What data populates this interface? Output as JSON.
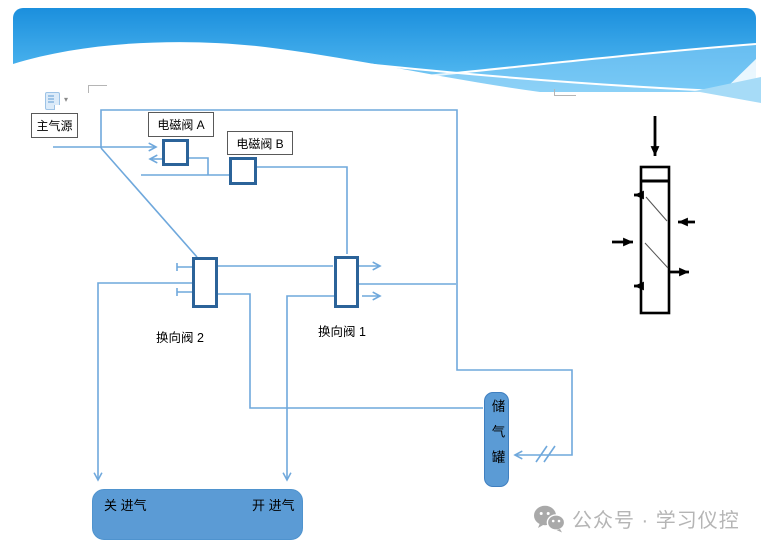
{
  "slide": {
    "toolbar": {
      "paste_icon": "clipboard-paste-icon",
      "dropdown_glyph": "▾"
    },
    "diagram": {
      "main_air_source": "主气源",
      "solenoid_valve_a": "电磁阀 A",
      "solenoid_valve_b": "电磁阀 B",
      "reversing_valve_2": "换向阀 2",
      "reversing_valve_1": "换向阀 1",
      "air_tank": "储气罐",
      "close_intake": "关 进气",
      "open_intake": "开 进气"
    },
    "colors": {
      "pipe_line": "#6fa8dc",
      "valve_border": "#2b6399",
      "node_fill": "#5b9bd5",
      "banner_top": "#1b8fdd",
      "banner_bottom": "#5cc0f4",
      "cylinder_stroke": "#000000",
      "watermark_gray": "#b5b5b5"
    },
    "watermark": {
      "icon": "wechat-icon",
      "text": "公众号 · 学习仪控"
    }
  }
}
